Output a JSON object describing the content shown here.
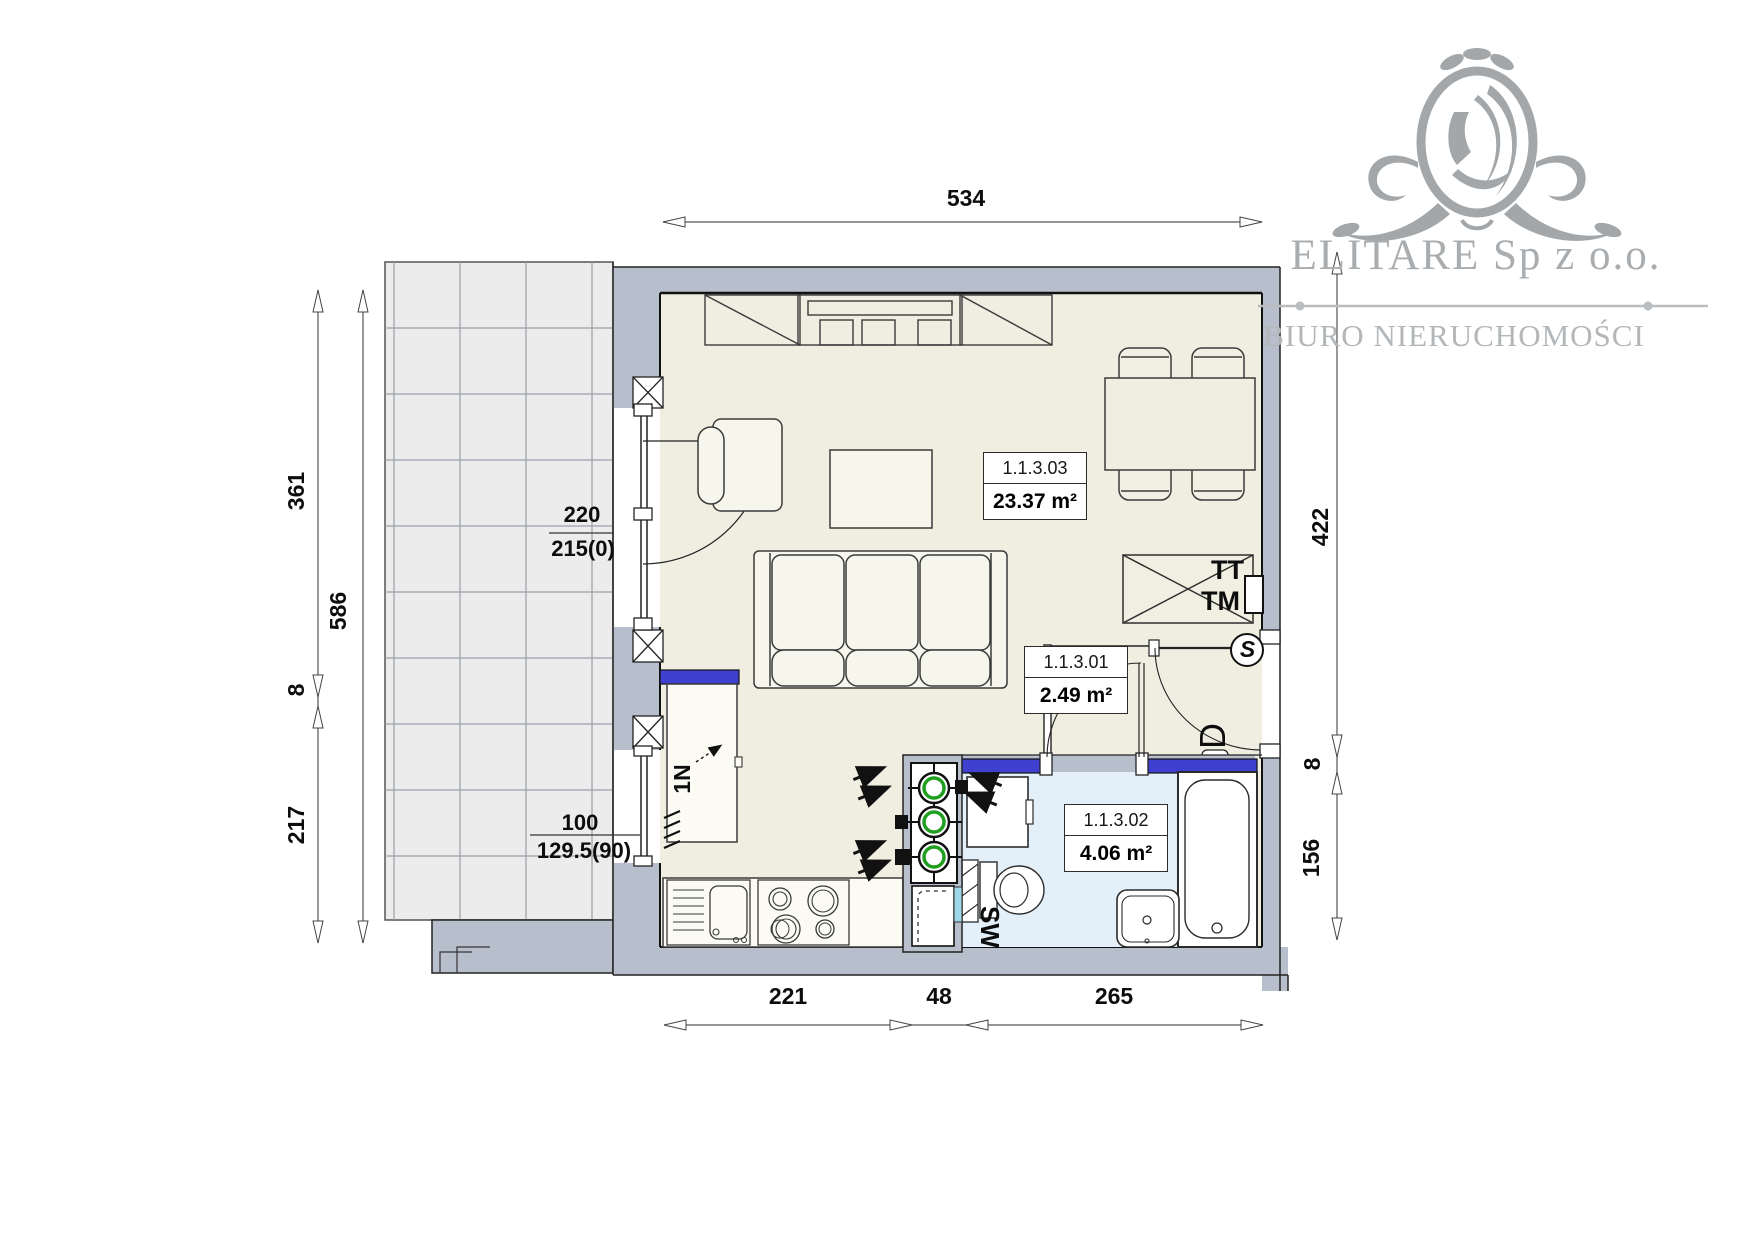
{
  "logo": {
    "company": "ELITARE Sp z o.o.",
    "tagline": "BIURO NIERUCHOMOŚCI"
  },
  "rooms": {
    "living": {
      "number": "1.1.3.03",
      "area": "23.37 m²"
    },
    "hall": {
      "number": "1.1.3.01",
      "area": "2.49 m²"
    },
    "bathroom": {
      "number": "1.1.3.02",
      "area": "4.06 m²"
    }
  },
  "dimensions": {
    "top_width": "534",
    "bottom": {
      "kitchen": "221",
      "shaft": "48",
      "bathroom": "265"
    },
    "left": {
      "upper": "361",
      "gap": "8",
      "lower": "217",
      "total": "586"
    },
    "right": {
      "upper": "422",
      "gap": "8",
      "lower": "156"
    }
  },
  "openings": {
    "balcony_door": {
      "width": "220",
      "sill": "215(0)"
    },
    "kitchen_window": {
      "width": "100",
      "sill": "129.5(90)"
    }
  },
  "markers": {
    "media_tt": "TT",
    "media_tm": "TM",
    "entry_door": "D",
    "switch": "S",
    "soil_stack": "SW",
    "vent": "1N"
  },
  "colors": {
    "wall_gray": "#b8bfcc",
    "floor_beige": "#efeee1",
    "bathroom_blue": "#e3f0f9",
    "lintel_blue": "#3f3fd0",
    "pipe_green": "#1f9e1f",
    "logo_gray": "#a3a7aa",
    "balcony_tile": "#ececec"
  }
}
